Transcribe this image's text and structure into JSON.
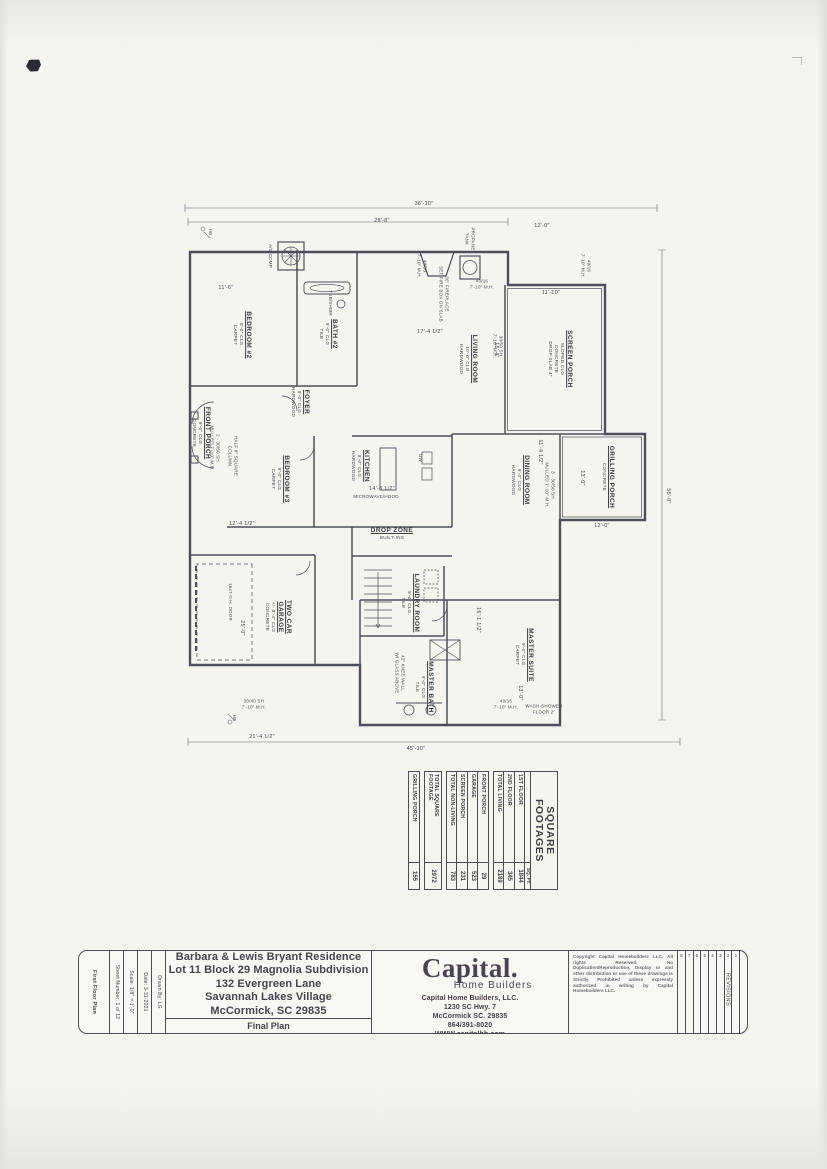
{
  "colors": {
    "paper": "#f5f4ef",
    "line": "#4e4e5c",
    "thin_line": "#6a6a78",
    "text": "#3d3d47"
  },
  "plan": {
    "rooms": [
      {
        "name": "SCREEN PORCH",
        "sub": [
          "SLOPED CLG",
          "CONCRETE",
          "DROP SLAB 4\""
        ],
        "x": 163,
        "y": 122
      },
      {
        "name": "GRILLING PORCH",
        "sub": [
          "CONCRETE"
        ],
        "x": 281,
        "y": 74
      },
      {
        "name": "LIVING ROOM",
        "sub": [
          "10'-0\" CLG",
          "HARDWOOD"
        ],
        "x": 163,
        "y": 214
      },
      {
        "name": "DINING ROOM",
        "sub": [
          "9'-0\" CLG",
          "HARDWOOD"
        ],
        "x": 284,
        "y": 162
      },
      {
        "name": "KITCHEN",
        "sub": [
          "9'-0\" CLG",
          "HARDWOOD"
        ],
        "x": 270,
        "y": 322
      },
      {
        "name": "FOYER",
        "sub": [
          "9'-0\" CLG",
          "HARDWOOD"
        ],
        "x": 206,
        "y": 382
      },
      {
        "name": "BEDROOM #2",
        "sub": [
          "9'-0\" CLG.",
          "CARPET"
        ],
        "x": 139,
        "y": 440
      },
      {
        "name": "BATH #2",
        "sub": [
          "9'-0\" CLG",
          "TILE"
        ],
        "x": 138,
        "y": 354
      },
      {
        "name": "FRONT PORCH",
        "sub": [
          "9'-0\" CLG",
          "CONCRETE"
        ],
        "x": 237,
        "y": 481
      },
      {
        "name": "BEDROOM #3",
        "sub": [
          "9'-0\" CLG",
          "CARPET"
        ],
        "x": 283,
        "y": 402
      },
      {
        "name": "TWO CAR\nGARAGE",
        "sub": [
          "+/- 9'-4\" CLG",
          "CONCRETE"
        ],
        "x": 421,
        "y": 404
      },
      {
        "name": "LAUNDRY ROOM",
        "sub": [
          "9'-0\" CLG.",
          "TILE"
        ],
        "x": 407,
        "y": 272
      },
      {
        "name": "MASTER SUITE",
        "sub": [
          "9'-0\" CLG.",
          "CARPET"
        ],
        "x": 459,
        "y": 158
      },
      {
        "name": "MASTER BATH",
        "sub": [
          "9'-0\" CLG",
          "TILE"
        ],
        "x": 491,
        "y": 258
      },
      {
        "name": "DROP ZONE",
        "sub": [
          "BUILT-INS"
        ],
        "x": 338,
        "y": 290,
        "r": -90
      }
    ],
    "dims": [
      {
        "t": "36'-10\"",
        "x": 8,
        "y": 258,
        "r": -90
      },
      {
        "t": "28'-8\"",
        "x": 25,
        "y": 300,
        "r": -90
      },
      {
        "t": "56'-0\"",
        "x": 300,
        "y": 14
      },
      {
        "t": "45'-10\"",
        "x": 553,
        "y": 266,
        "r": -90
      },
      {
        "t": "12'-0\"",
        "x": 30,
        "y": 140,
        "r": -90
      },
      {
        "t": "11'-10\"",
        "x": 97,
        "y": 131,
        "r": -90
      },
      {
        "t": "15'-4\"",
        "x": 154,
        "y": 186
      },
      {
        "t": "13'-0\"",
        "x": 282,
        "y": 100
      },
      {
        "t": "12'-0\"",
        "x": 330,
        "y": 80,
        "r": -90
      },
      {
        "t": "11'-4 1/2\"",
        "x": 256,
        "y": 142
      },
      {
        "t": "14'-8 1/2\"",
        "x": 293,
        "y": 300,
        "r": -90
      },
      {
        "t": "11'-6\"",
        "x": 92,
        "y": 456,
        "r": -90
      },
      {
        "t": "12'-4 1/2\"",
        "x": 328,
        "y": 440,
        "r": -90
      },
      {
        "t": "17'-4 1/2\"",
        "x": 136,
        "y": 252,
        "r": -90
      },
      {
        "t": "16'-1 1/2\"",
        "x": 424,
        "y": 204
      },
      {
        "t": "13'-0\"",
        "x": 497,
        "y": 162
      },
      {
        "t": "21'-4 1/2\"",
        "x": 541,
        "y": 420,
        "r": -90
      },
      {
        "t": "25'-0\"",
        "x": 432,
        "y": 440
      }
    ],
    "notes": [
      {
        "t": "A/C COMP",
        "x": 60,
        "y": 412
      },
      {
        "t": "PROPANE\nTANK",
        "x": 43,
        "y": 212
      },
      {
        "t": "36\" FIREPLACE\nSET FIRE BOX ON SLAB",
        "x": 98,
        "y": 238
      },
      {
        "t": "40/10\n7'-10\" M.H.",
        "x": 70,
        "y": 260
      },
      {
        "t": "40/16\n7'-10\" M.H.",
        "x": 70,
        "y": 96
      },
      {
        "t": "40/16\n7'-10\" M.H.",
        "x": 88,
        "y": 200,
        "r": -90
      },
      {
        "t": "30/50 SH\n7'-10\" M.H.",
        "x": 150,
        "y": 184
      },
      {
        "t": "30/40 SH\n7'-10\" M.H.",
        "x": 508,
        "y": 428,
        "r": -90
      },
      {
        "t": "40/16\n7'-10\" M.H.",
        "x": 508,
        "y": 176,
        "r": -90
      },
      {
        "t": "WASH-SHOWER\nFLOOR 2\"",
        "x": 513,
        "y": 138,
        "r": -90
      },
      {
        "t": "2 - 30/50 SH\nMULLED 7'-10\" M.H.",
        "x": 252,
        "y": 467
      },
      {
        "t": "3 - 30/50 SH\nMULLED 7'-10\" M.H.",
        "x": 289,
        "y": 132
      },
      {
        "t": "HALF 8\" SQUARE\nCOLUMN",
        "x": 260,
        "y": 449
      },
      {
        "t": "MICROWAVE/HOOD",
        "x": 301,
        "y": 306,
        "r": -90
      },
      {
        "t": "16x7 O.H. DOOR",
        "x": 406,
        "y": 452
      },
      {
        "t": "TUB/SHWR",
        "x": 107,
        "y": 352
      },
      {
        "t": "42\" KNEE WALL\nW/ GLASS ABOVE",
        "x": 477,
        "y": 282
      },
      {
        "t": "DW",
        "x": 262,
        "y": 262
      },
      {
        "t": "HB",
        "x": 36,
        "y": 472
      },
      {
        "t": "HB",
        "x": 522,
        "y": 448
      }
    ]
  },
  "footage_table": {
    "title": "SQUARE\nFOOTAGES",
    "value_header": "SQ. FT.",
    "groups": [
      {
        "rows": [
          [
            "1ST FLOOR",
            "1844"
          ],
          [
            "2ND FLOOR",
            "345"
          ],
          [
            "TOTAL LIVING",
            "2189"
          ]
        ]
      },
      {
        "rows": [
          [
            "FRONT PORCH",
            "29"
          ],
          [
            "GARAGE",
            "523"
          ],
          [
            "SCREEN PORCH",
            "231"
          ],
          [
            "TOTAL NON-LIVING",
            "783"
          ]
        ]
      },
      {
        "rows": [
          [
            "TOTAL SQUARE\nFOOTAGE",
            "2972"
          ]
        ]
      },
      {
        "rows": [
          [
            "GRILLING PORCH",
            "155"
          ]
        ]
      }
    ]
  },
  "title_block": {
    "strips": [
      {
        "text": "First Floor Plan",
        "wide": true
      },
      {
        "text": "Sheet Number: 1 of 12"
      },
      {
        "text": "Scale: 1/8\" = 1'-0\""
      },
      {
        "text": "Date: 3-31-2021"
      },
      {
        "text": "Drawn By: LG"
      }
    ],
    "address_lines": [
      "Barbara & Lewis Bryant Residence",
      "Lot 11 Block 29 Magnolia Subdivision",
      "132 Evergreen Lane",
      "Savannah Lakes Village",
      "McCormick, SC 29835"
    ],
    "final_plan": "Final Plan",
    "builder": {
      "logo": "Capital.",
      "logo_sub": "Home Builders",
      "lines": [
        "Capital Home Builders, LLC.",
        "1230 SC Hwy. 7",
        "McCormick SC. 29835",
        "864/391-8020",
        "WWW.capitalhb.com"
      ]
    },
    "copyright": "Copyright Capital Homebuilders LLC.  All rights Reserved.  No Duplication/Reproduction, Display or and other distribution or use of these drawings is Strictly Prohibited unless expressly authorized in writing by Capital Homebuilders LLC.",
    "revisions": {
      "header": "REVISIONS",
      "numbers": [
        "8",
        "7",
        "6",
        "5",
        "4",
        "3",
        "2",
        "1"
      ]
    }
  }
}
